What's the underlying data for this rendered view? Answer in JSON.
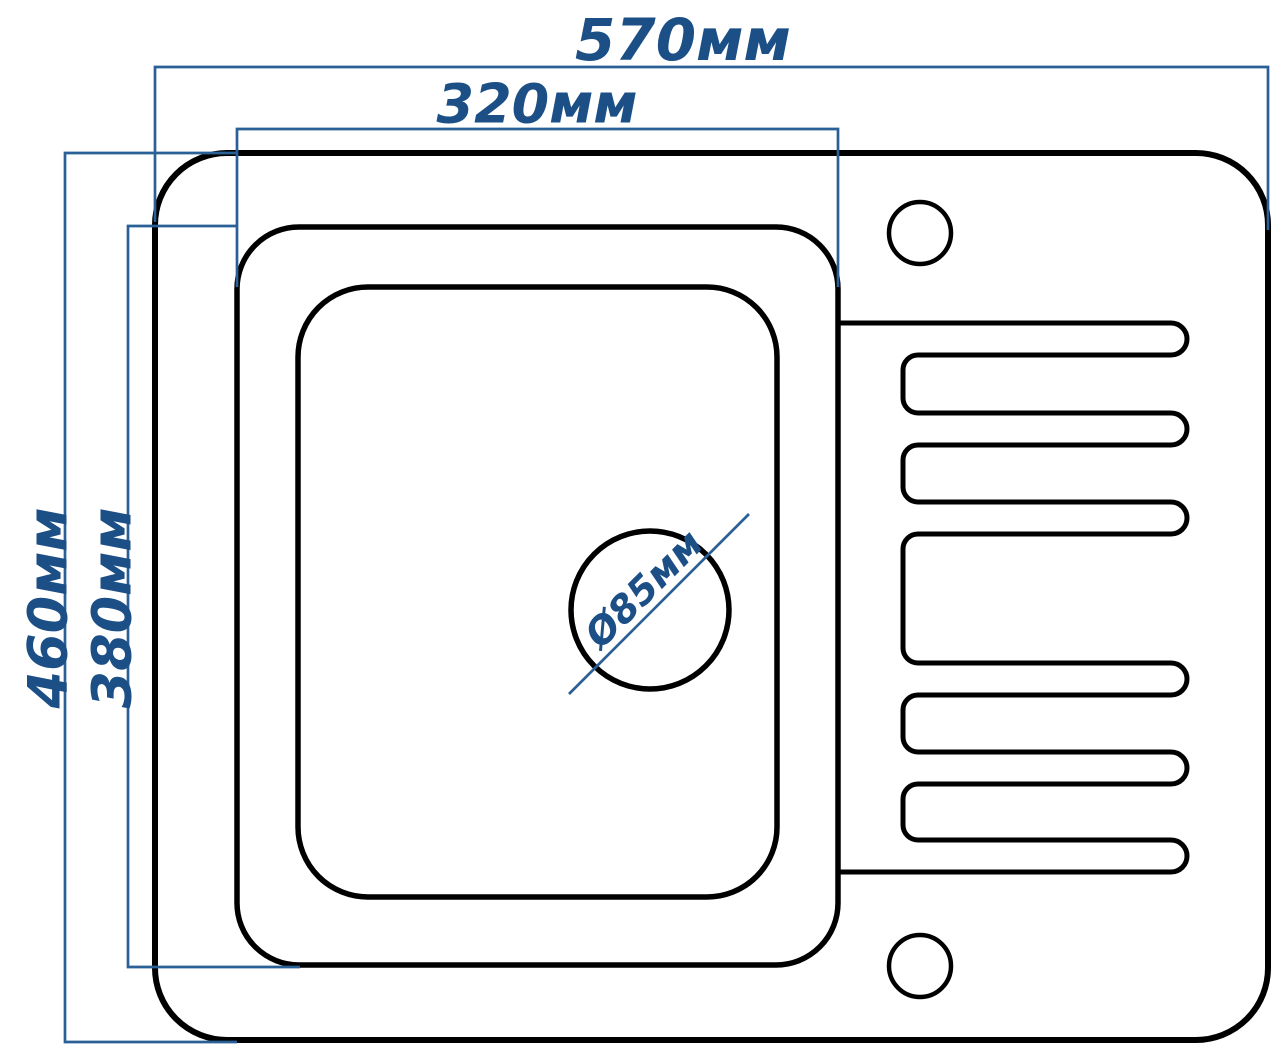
{
  "page": {
    "type": "technical-drawing",
    "subject": "kitchen sink top view with dimensions",
    "background": "#ffffff"
  },
  "colors": {
    "outline_black": "#000000",
    "dimension_line_blue": "#2a6095",
    "dimension_text_blue": "#1b4f86"
  },
  "dimensions": {
    "overall_width": {
      "label": "570мм",
      "value": 570,
      "unit": "мм"
    },
    "bowl_width": {
      "label": "320мм",
      "value": 320,
      "unit": "мм"
    },
    "overall_depth": {
      "label": "460мм",
      "value": 460,
      "unit": "мм"
    },
    "bowl_depth": {
      "label": "380мм",
      "value": 380,
      "unit": "мм"
    },
    "drain_diameter": {
      "label": "Ø85мм",
      "value": 85,
      "unit": "мм"
    }
  },
  "features": {
    "faucet_holes": 2,
    "drain_holes": 1,
    "drainboard_grooves": 6
  }
}
